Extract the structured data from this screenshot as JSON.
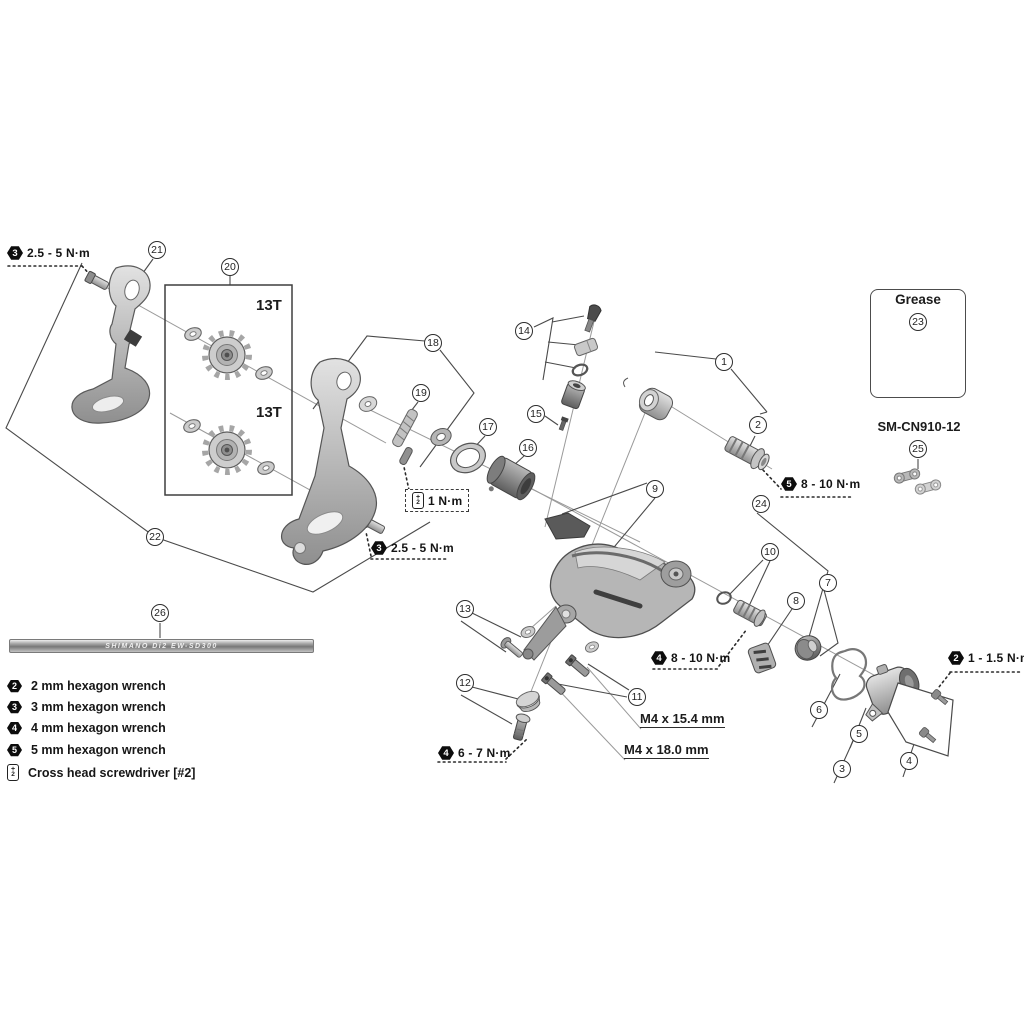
{
  "diagram": {
    "type": "exploded-parts-diagram",
    "subject": "rear derailleur assembly"
  },
  "callouts": {
    "c1": "1",
    "c2": "2",
    "c3": "3",
    "c4": "4",
    "c5": "5",
    "c6": "6",
    "c7": "7",
    "c8": "8",
    "c9": "9",
    "c10": "10",
    "c11": "11",
    "c12": "12",
    "c13": "13",
    "c14": "14",
    "c15": "15",
    "c16": "16",
    "c17": "17",
    "c18": "18",
    "c19": "19",
    "c20": "20",
    "c21": "21",
    "c22": "22",
    "c23": "23",
    "c24": "24",
    "c25": "25",
    "c26": "26"
  },
  "torque_labels": {
    "plate_bolt_top": {
      "tool": "3",
      "value": "2.5 - 5 N·m"
    },
    "plate_bolt_bottom": {
      "tool": "3",
      "value": "2.5 - 5 N·m"
    },
    "plate_screw": {
      "icon": "cross-head-screwdriver",
      "value": "1 N·m"
    },
    "bracket_axle": {
      "tool": "5",
      "value": "8 - 10 N·m"
    },
    "cable_unit": {
      "tool": "4",
      "value": "8 - 10 N·m"
    },
    "stay_bolt": {
      "tool": "4",
      "value": "6 - 7 N·m"
    },
    "cover_screws": {
      "tool": "2",
      "value": "1 - 1.5 N·m"
    }
  },
  "part_labels": {
    "pulley_top": "13T",
    "pulley_bottom": "13T",
    "grease": "Grease",
    "quick_link": "SM-CN910-12",
    "bolt_spec_a": "M4 x 15.4 mm",
    "bolt_spec_b": "M4 x 18.0 mm",
    "cable_print": "SHIMANO Di2 EW-SD300"
  },
  "screwdriver_icon": {
    "top": "+",
    "bottom": "2"
  },
  "legend": {
    "items": [
      {
        "tool": "2",
        "label": "2 mm hexagon wrench"
      },
      {
        "tool": "3",
        "label": "3 mm hexagon wrench"
      },
      {
        "tool": "4",
        "label": "4 mm hexagon wrench"
      },
      {
        "tool": "5",
        "label": "5 mm hexagon wrench"
      },
      {
        "tool": "cross-head-screwdriver",
        "label": "Cross head screwdriver [#2]"
      }
    ]
  }
}
